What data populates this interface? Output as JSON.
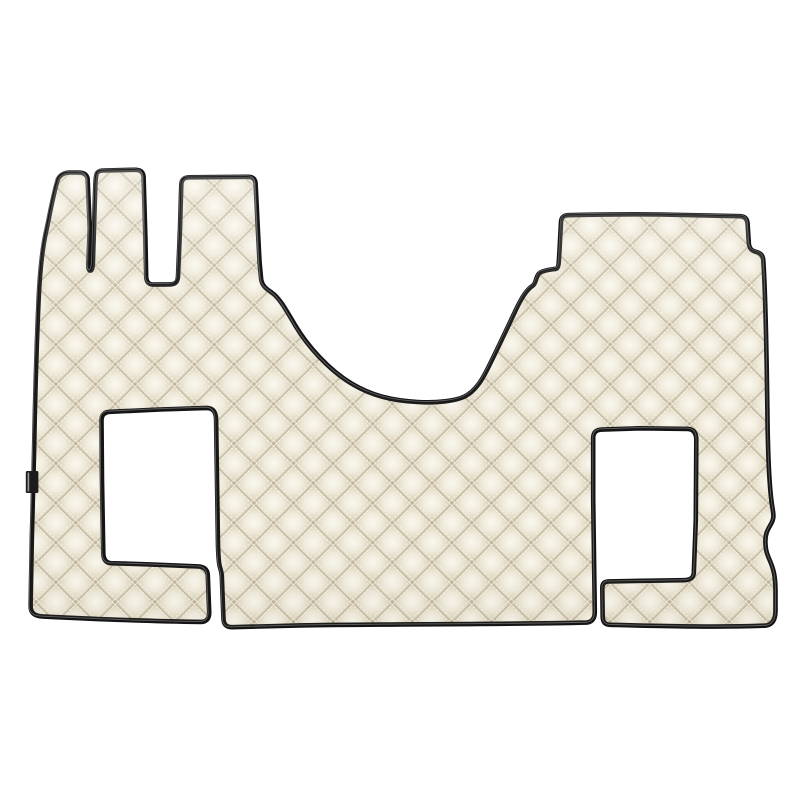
{
  "page": {
    "background_color": "#ffffff"
  },
  "photo": {
    "alt": "Beige diamond-quilted eco-leather truck floor mat set with black piping trim, two rectangular seat cut-outs connected to the bottom edge by narrow slits, three tab-shaped prongs at the top left, a raised rectangular section at the top right, a deep curved engine-tunnel notch at the top center, and a small black fabric brand tab on the left edge, photographed flat on a white background",
    "subject": "quilted floor mat",
    "colors": {
      "background": "#ffffff",
      "mat_base": "#f1ede0",
      "quilt_highlight": "#faf8ef",
      "quilt_mid": "#f0ebdc",
      "quilt_shadow": "#ddd5bf",
      "quilt_seam": "#bdb296",
      "stitch": "#fcfaf2",
      "trim": "#141414",
      "trim_highlight": "#9a9a9a",
      "label_tab": "#1c1c1c"
    },
    "features": {
      "prong_count": 3,
      "cutout_count": 2,
      "trim_style": "black piping",
      "pattern": "diamond quilting"
    }
  }
}
